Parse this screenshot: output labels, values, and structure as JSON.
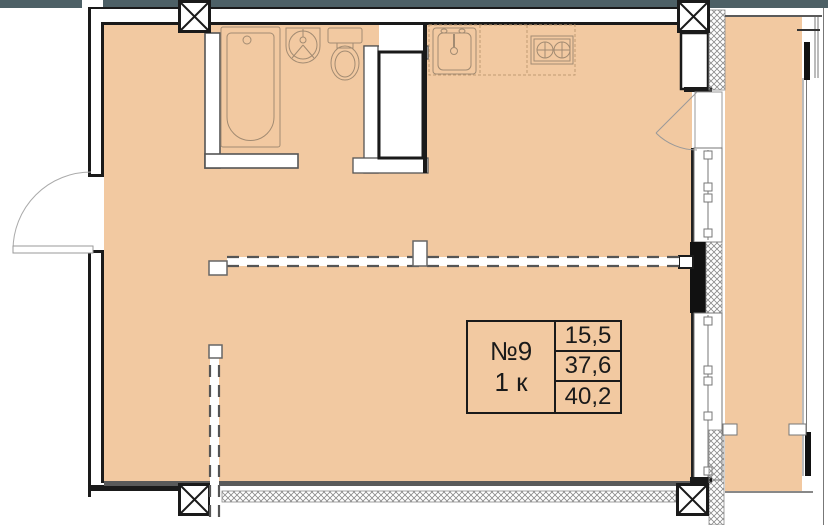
{
  "unit": {
    "number": "№9",
    "rooms": "1 к",
    "areas": [
      "15,5",
      "37,6",
      "40,2"
    ]
  },
  "colors": {
    "floor": "#f2c9a1",
    "top_band": "#4d6066",
    "wall_line": "#1a1a1a",
    "wall_gray": "#555555",
    "fixture_line": "#a28b72",
    "hatch_line": "#8a8a8a",
    "thin_gray": "#777777"
  },
  "legend": {
    "fixtures": [
      "bathtub",
      "washbasin",
      "toilet",
      "kitchen-sink",
      "stove",
      "ventilation-shaft"
    ],
    "symbols": [
      "structural-column",
      "entrance-door-swing",
      "balcony-door-swing",
      "window",
      "insulated-wall-hatch",
      "planned-partition-dashed",
      "balcony"
    ]
  }
}
